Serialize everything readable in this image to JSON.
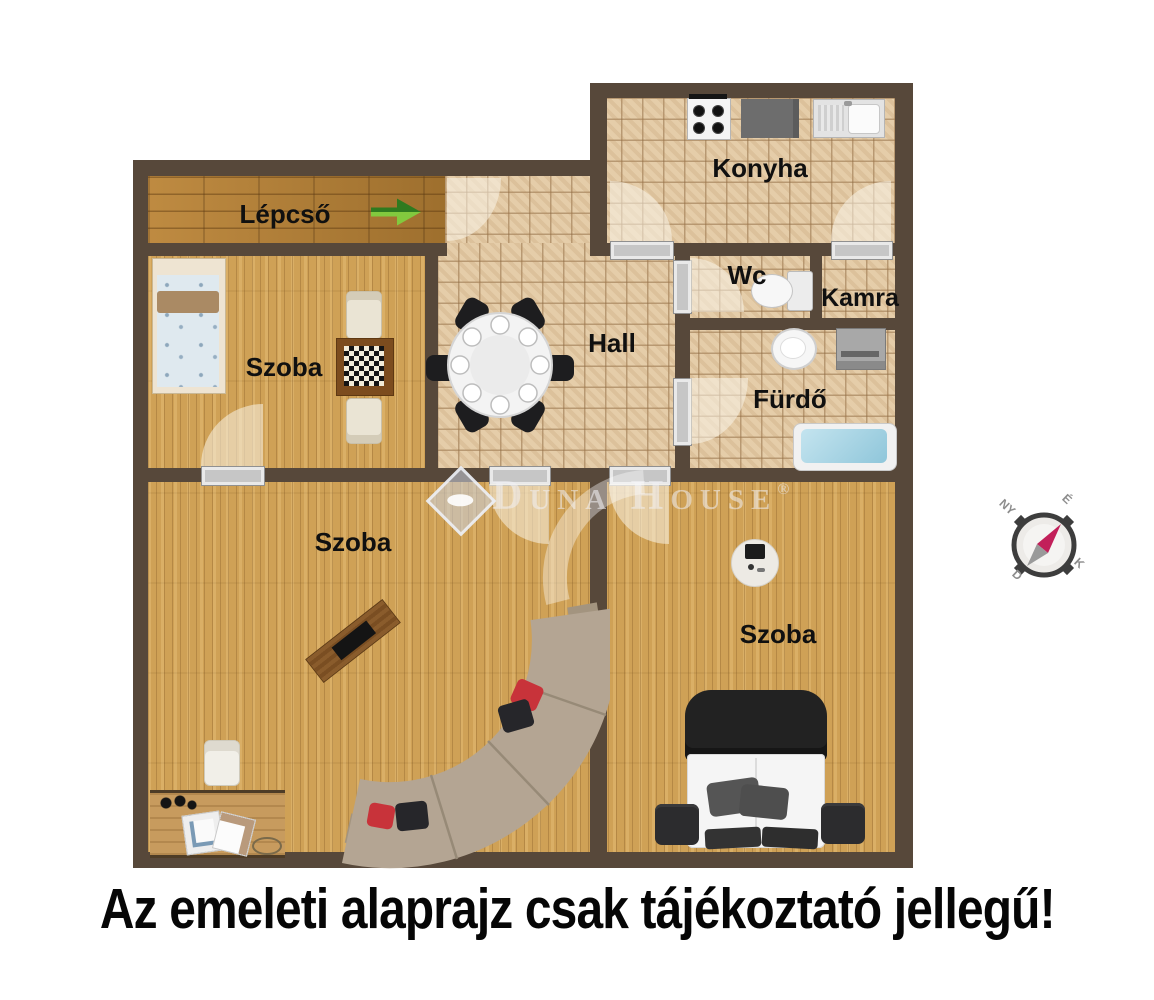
{
  "banner": {
    "text": "Az emeleti alaprajz csak tájékoztató jellegű!"
  },
  "rooms": {
    "lepcso": {
      "label": "Lépcső"
    },
    "szoba_top_left": {
      "label": "Szoba"
    },
    "hall": {
      "label": "Hall"
    },
    "konyha": {
      "label": "Konyha"
    },
    "wc": {
      "label": "Wc"
    },
    "kamra": {
      "label": "Kamra"
    },
    "furdo": {
      "label": "Fürdő"
    },
    "szoba_bottom_left": {
      "label": "Szoba"
    },
    "szoba_bottom_right": {
      "label": "Szoba"
    }
  },
  "compass": {
    "north": "É",
    "east": "K",
    "south": "D",
    "west": "NY"
  },
  "watermark": {
    "brand": "Duna House",
    "registered": "®"
  },
  "colors": {
    "wall": "#57483a",
    "tile_floor": "#e5cda9",
    "room_wood": "#cfa156",
    "corridor_wood": "#b07c33",
    "arrow_dark_green": "#2f7a1f",
    "arrow_light_green": "#82c93e",
    "bathtub_blue": "#a5d4e4",
    "compass_needle_red": "#c2205a"
  }
}
